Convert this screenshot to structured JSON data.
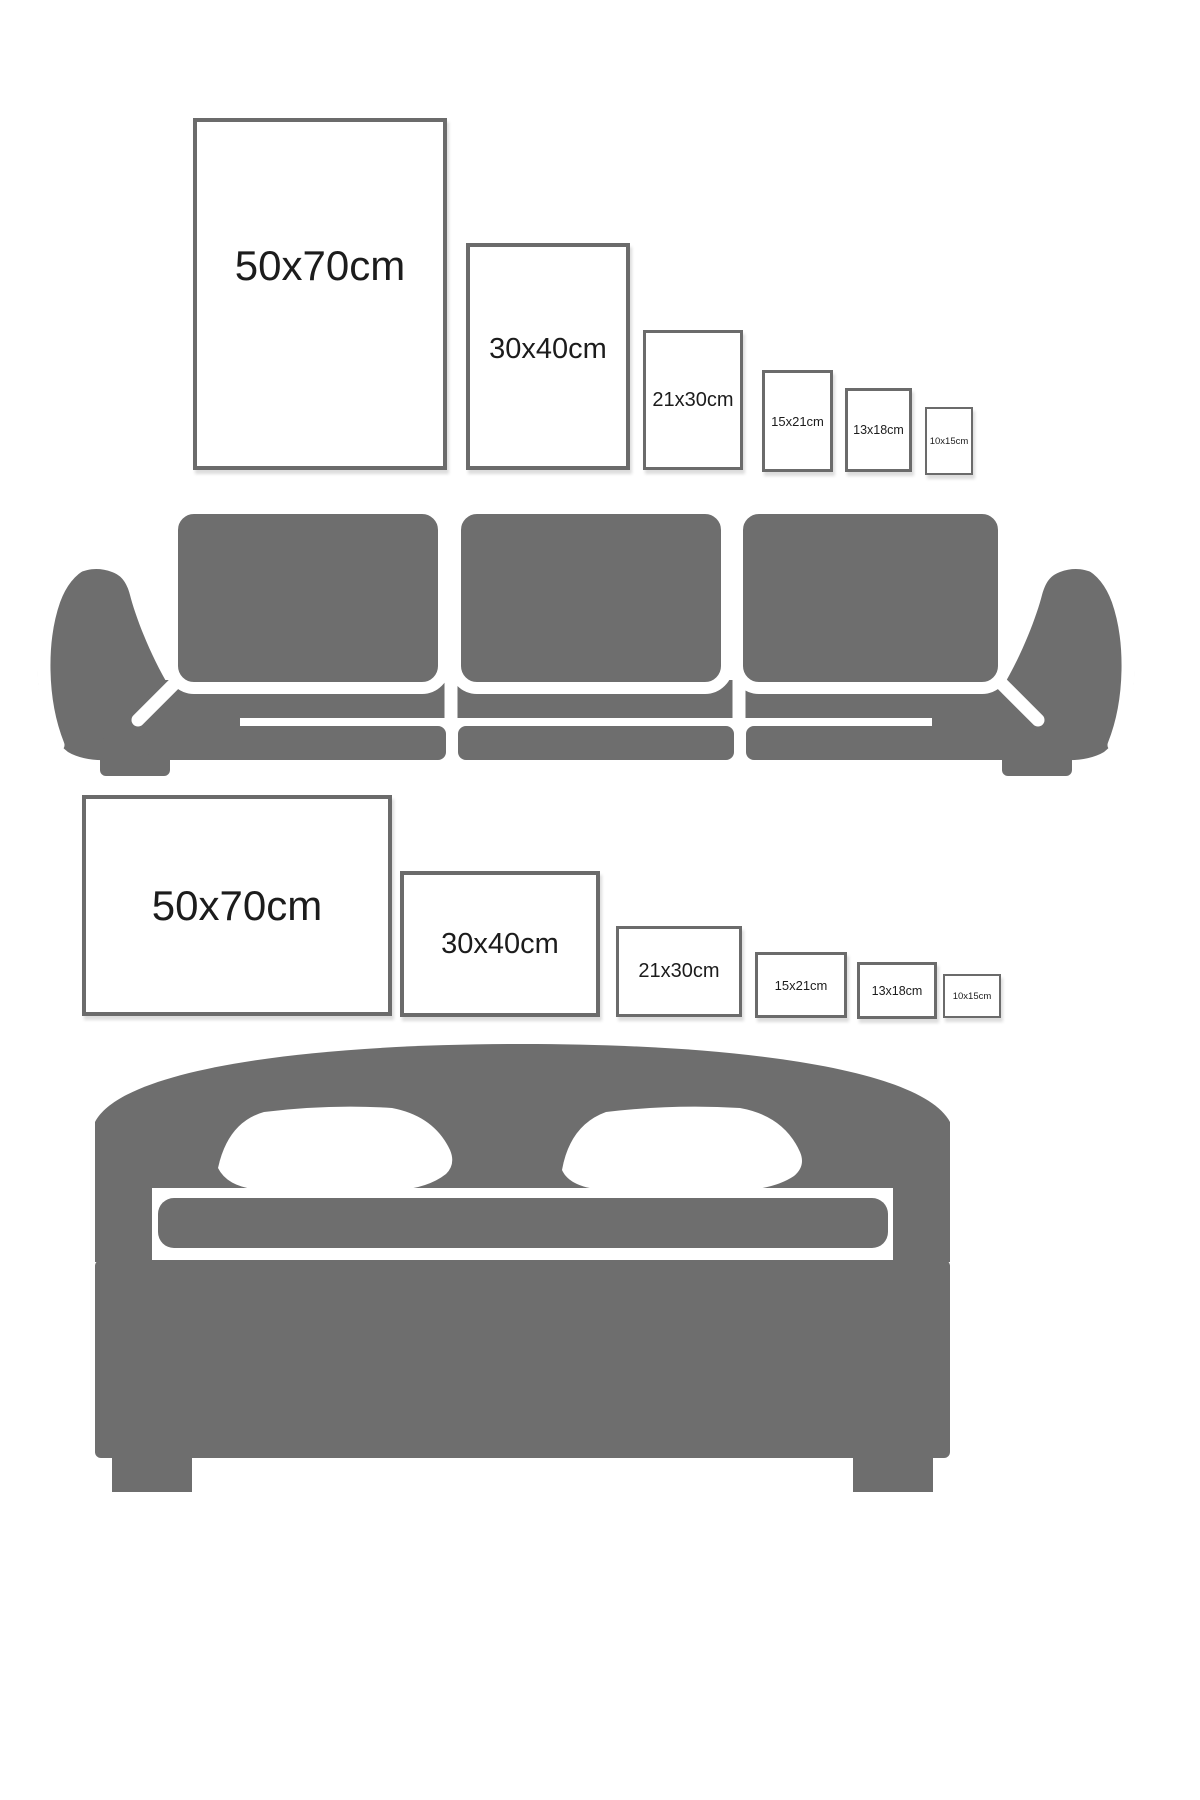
{
  "title": "Frame size comparison",
  "colors": {
    "furniture_gray": "#6e6e6e",
    "frame_border": "#6b6b6b",
    "label_text": "#1c1c1c",
    "background": "#ffffff"
  },
  "top_section": {
    "furniture": "sofa",
    "orientation": "portrait",
    "frames": [
      {
        "label": "50x70cm"
      },
      {
        "label": "30x40cm"
      },
      {
        "label": "21x30cm"
      },
      {
        "label": "15x21cm"
      },
      {
        "label": "13x18cm"
      },
      {
        "label": "10x15cm"
      }
    ]
  },
  "bottom_section": {
    "furniture": "bed",
    "orientation": "landscape",
    "frames": [
      {
        "label": "50x70cm"
      },
      {
        "label": "30x40cm"
      },
      {
        "label": "21x30cm"
      },
      {
        "label": "15x21cm"
      },
      {
        "label": "13x18cm"
      },
      {
        "label": "10x15cm"
      }
    ]
  }
}
